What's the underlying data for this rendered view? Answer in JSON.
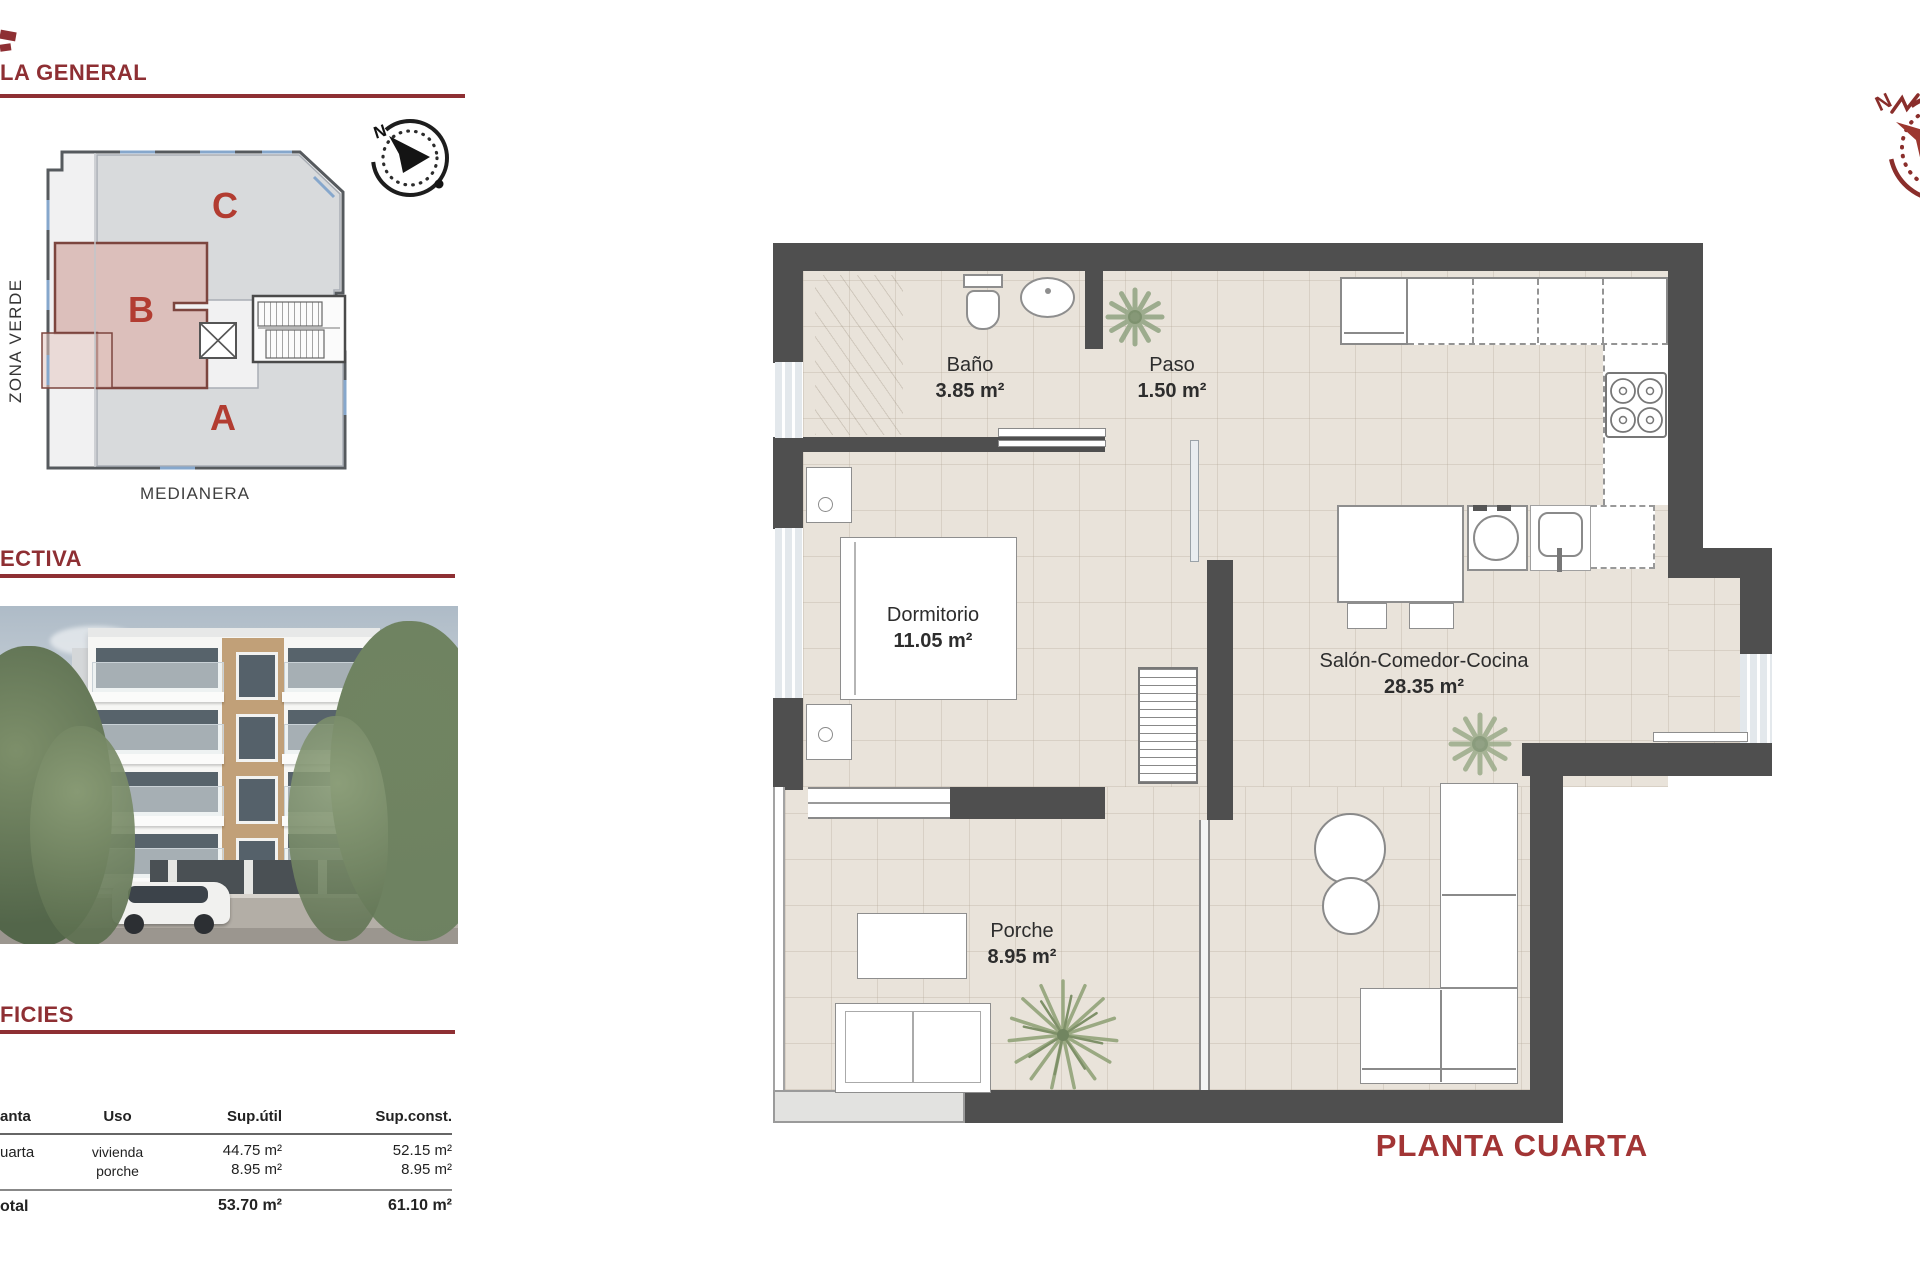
{
  "sections": {
    "general": "LA GENERAL",
    "perspective": "ECTIVA",
    "surfaces": "FICIES"
  },
  "site_plan": {
    "unit_a": "A",
    "unit_b": "B",
    "unit_c": "C",
    "zona_verde": "ZONA VERDE",
    "medianera": "MEDIANERA",
    "compass_n": "N"
  },
  "surfaces_table": {
    "headers": {
      "planta": "anta",
      "uso": "Uso",
      "sup_util": "Sup.útil",
      "sup_const": "Sup.const."
    },
    "row": {
      "planta": "uarta",
      "uso_1": "vivienda",
      "uso_2": "porche",
      "util_1": "44.75 m²",
      "util_2": "8.95 m²",
      "const_1": "52.15 m²",
      "const_2": "8.95 m²"
    },
    "total": {
      "label": "otal",
      "util": "53.70 m²",
      "const": "61.10 m²"
    }
  },
  "floor_plan": {
    "title": "PLANTA CUARTA",
    "compass_n": "N",
    "rooms": [
      {
        "name": "Baño",
        "area": "3.85 m²"
      },
      {
        "name": "Paso",
        "area": "1.50 m²"
      },
      {
        "name": "Dormitorio",
        "area": "11.05 m²"
      },
      {
        "name": "Salón-Comedor-Cocina",
        "area": "28.35 m²"
      },
      {
        "name": "Porche",
        "area": "8.95 m²"
      }
    ]
  },
  "colors": {
    "accent_red": "#8e2f33",
    "title_red": "#a23535",
    "wall_gray": "#4f4f4f",
    "floor_beige": "#e9e3da",
    "unit_b_fill": "#c59089"
  }
}
